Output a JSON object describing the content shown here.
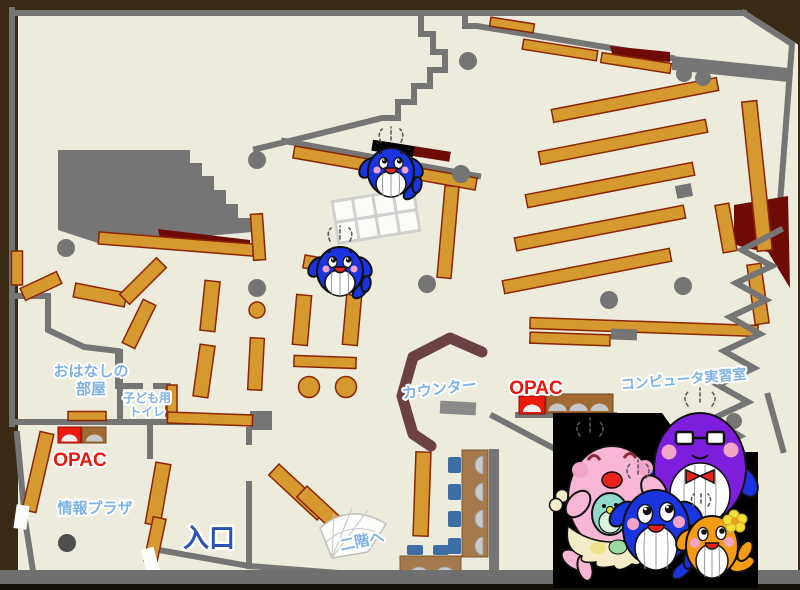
{
  "labels": {
    "story_room_line1": "おはなしの",
    "story_room_line2": "部屋",
    "kids_toilet_line1": "子ども用",
    "kids_toilet_line2": "トイレ",
    "opac_left": "OPAC",
    "opac_right": "OPAC",
    "info_plaza": "情報プラザ",
    "entrance": "入口",
    "counter": "カウンター",
    "computer_room": "コンピュータ実習室",
    "to_second_floor": "二階へ"
  },
  "colors": {
    "background": "#3A2B16",
    "floor": "#EDECDC",
    "wall": "#757575",
    "shelf": "#D6992F",
    "shelf_border": "#8B2504",
    "accent_dark_red": "#6F0B07",
    "counter_brown": "#6B4144",
    "label_blue": "#7FB2E4",
    "label_red": "#E8170D",
    "entrance_blue": "#2A52B4",
    "table_brown": "#A4794C",
    "chair_blue": "#3D6FA6"
  }
}
